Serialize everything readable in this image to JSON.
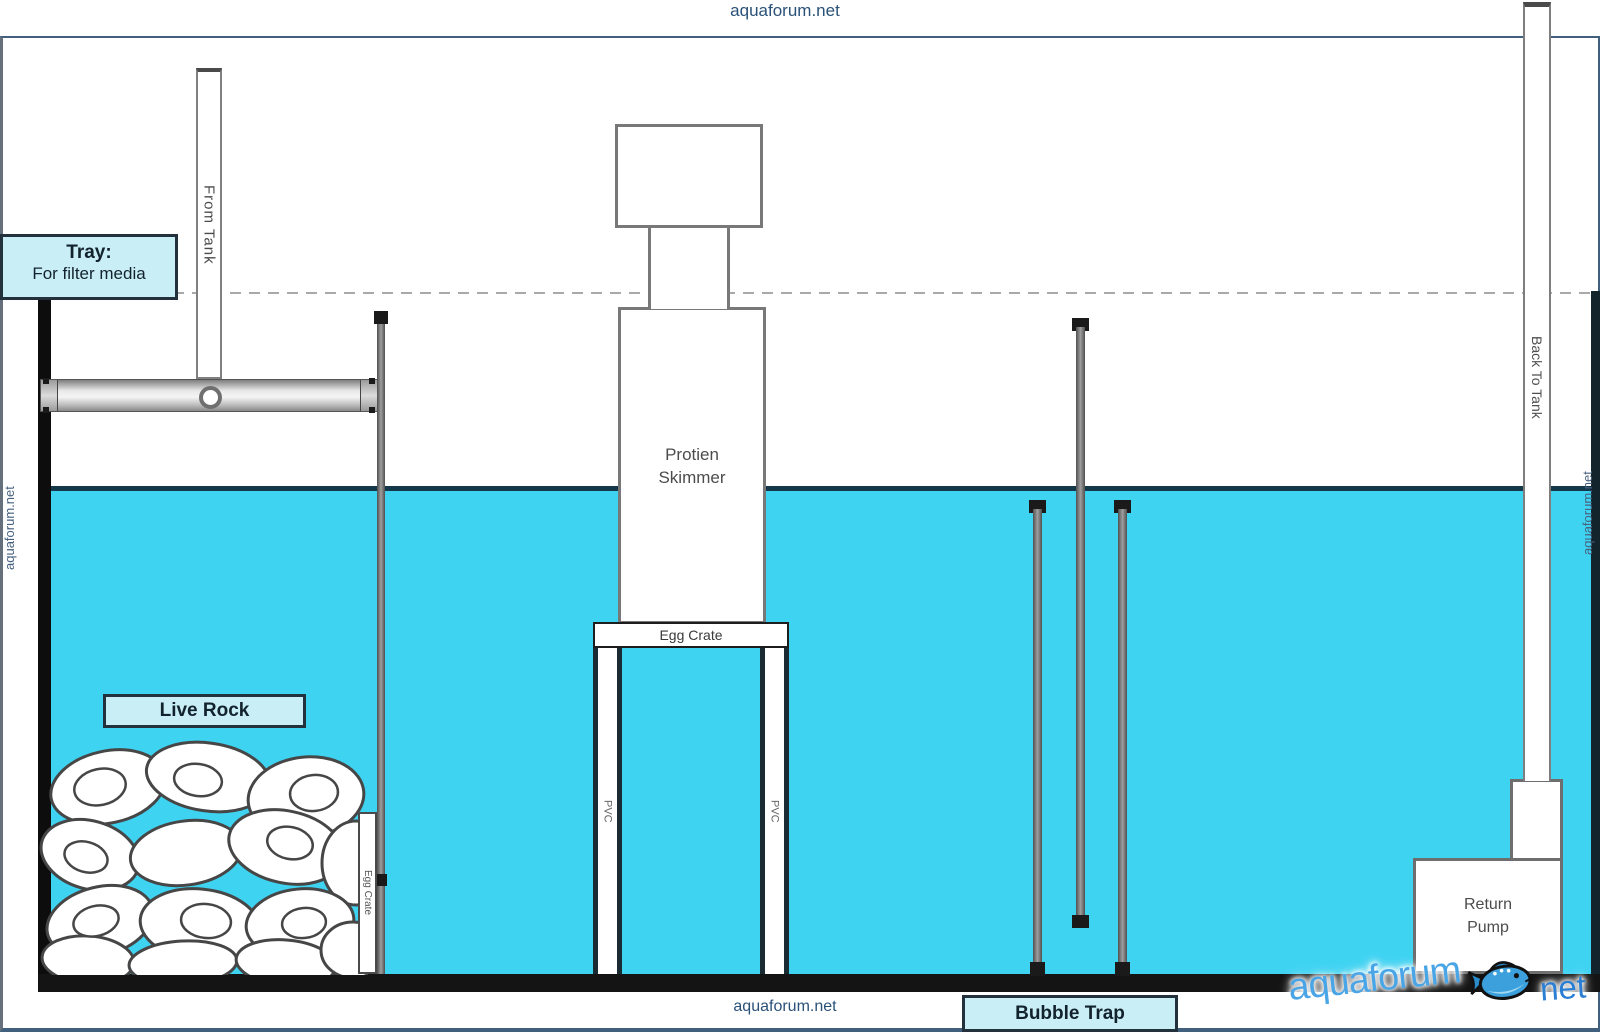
{
  "watermarks": {
    "top": "aquaforum.net",
    "bottom": "aquaforum.net",
    "left": "aquaforum.net",
    "right": "aquaforum.net"
  },
  "logo": {
    "brand": "aquaforum",
    "tld": "net"
  },
  "callouts": {
    "tray": {
      "title": "Tray:",
      "subtitle": "For filter media"
    },
    "live_rock": "Live Rock",
    "bubble_trap": "Bubble Trap"
  },
  "equipment": {
    "from_tank_pipe": "From Tank",
    "back_to_tank_pipe": "Back To Tank",
    "protein_skimmer": "Protien\nSkimmer",
    "egg_crate_platform": "Egg Crate",
    "egg_crate_vertical": "Egg Crate",
    "pvc_left": "PVC",
    "pvc_right": "PVC",
    "return_pump": "Return\nPump"
  },
  "colors": {
    "water": "#3fd3f2",
    "water_surface_line": "#15374a",
    "callout_background": "#c9eef6",
    "callout_border": "#22313b",
    "watermark_text": "#2a5178",
    "logo_brand": "#4aa5e6",
    "logo_tld": "#2a7fd4"
  }
}
